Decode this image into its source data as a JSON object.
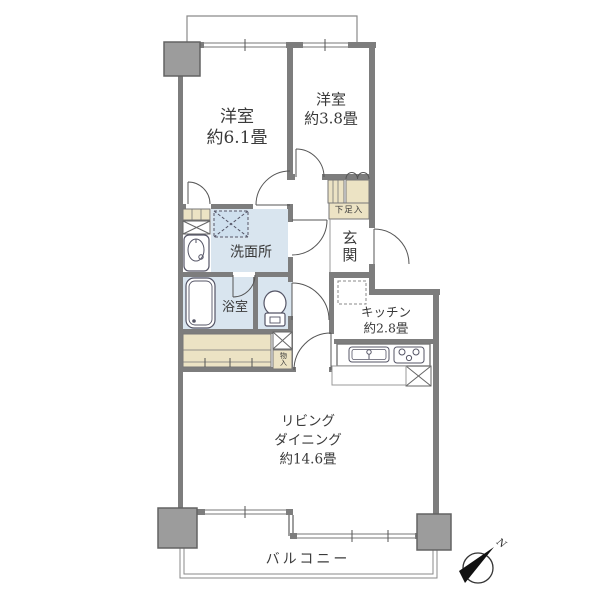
{
  "plan_type": "apartment-floor-plan",
  "rooms": {
    "bedroom_1": {
      "name": "洋室",
      "area": "約6.1畳"
    },
    "bedroom_2": {
      "name": "洋室",
      "area": "約3.8畳"
    },
    "washroom": {
      "name": "洗面所"
    },
    "bathroom": {
      "name": "浴室"
    },
    "entrance": {
      "name": "玄関"
    },
    "shoe_cabinet": {
      "name": "下足入"
    },
    "storage": {
      "name": "物入"
    },
    "kitchen": {
      "name": "キッチン",
      "area": "約2.8畳"
    },
    "living_dining": {
      "line1": "リビング",
      "line2": "ダイニング",
      "area": "約14.6畳"
    },
    "balcony": {
      "name": "バルコニー"
    }
  },
  "compass": {
    "label": "N"
  },
  "colors": {
    "wall": "#7d7d7d",
    "pillar": "#9c9c9c",
    "wet_area_floor": "#d9e5ef",
    "closet_fill": "#ece3c4",
    "line": "#777777",
    "text": "#3a3a3a"
  }
}
